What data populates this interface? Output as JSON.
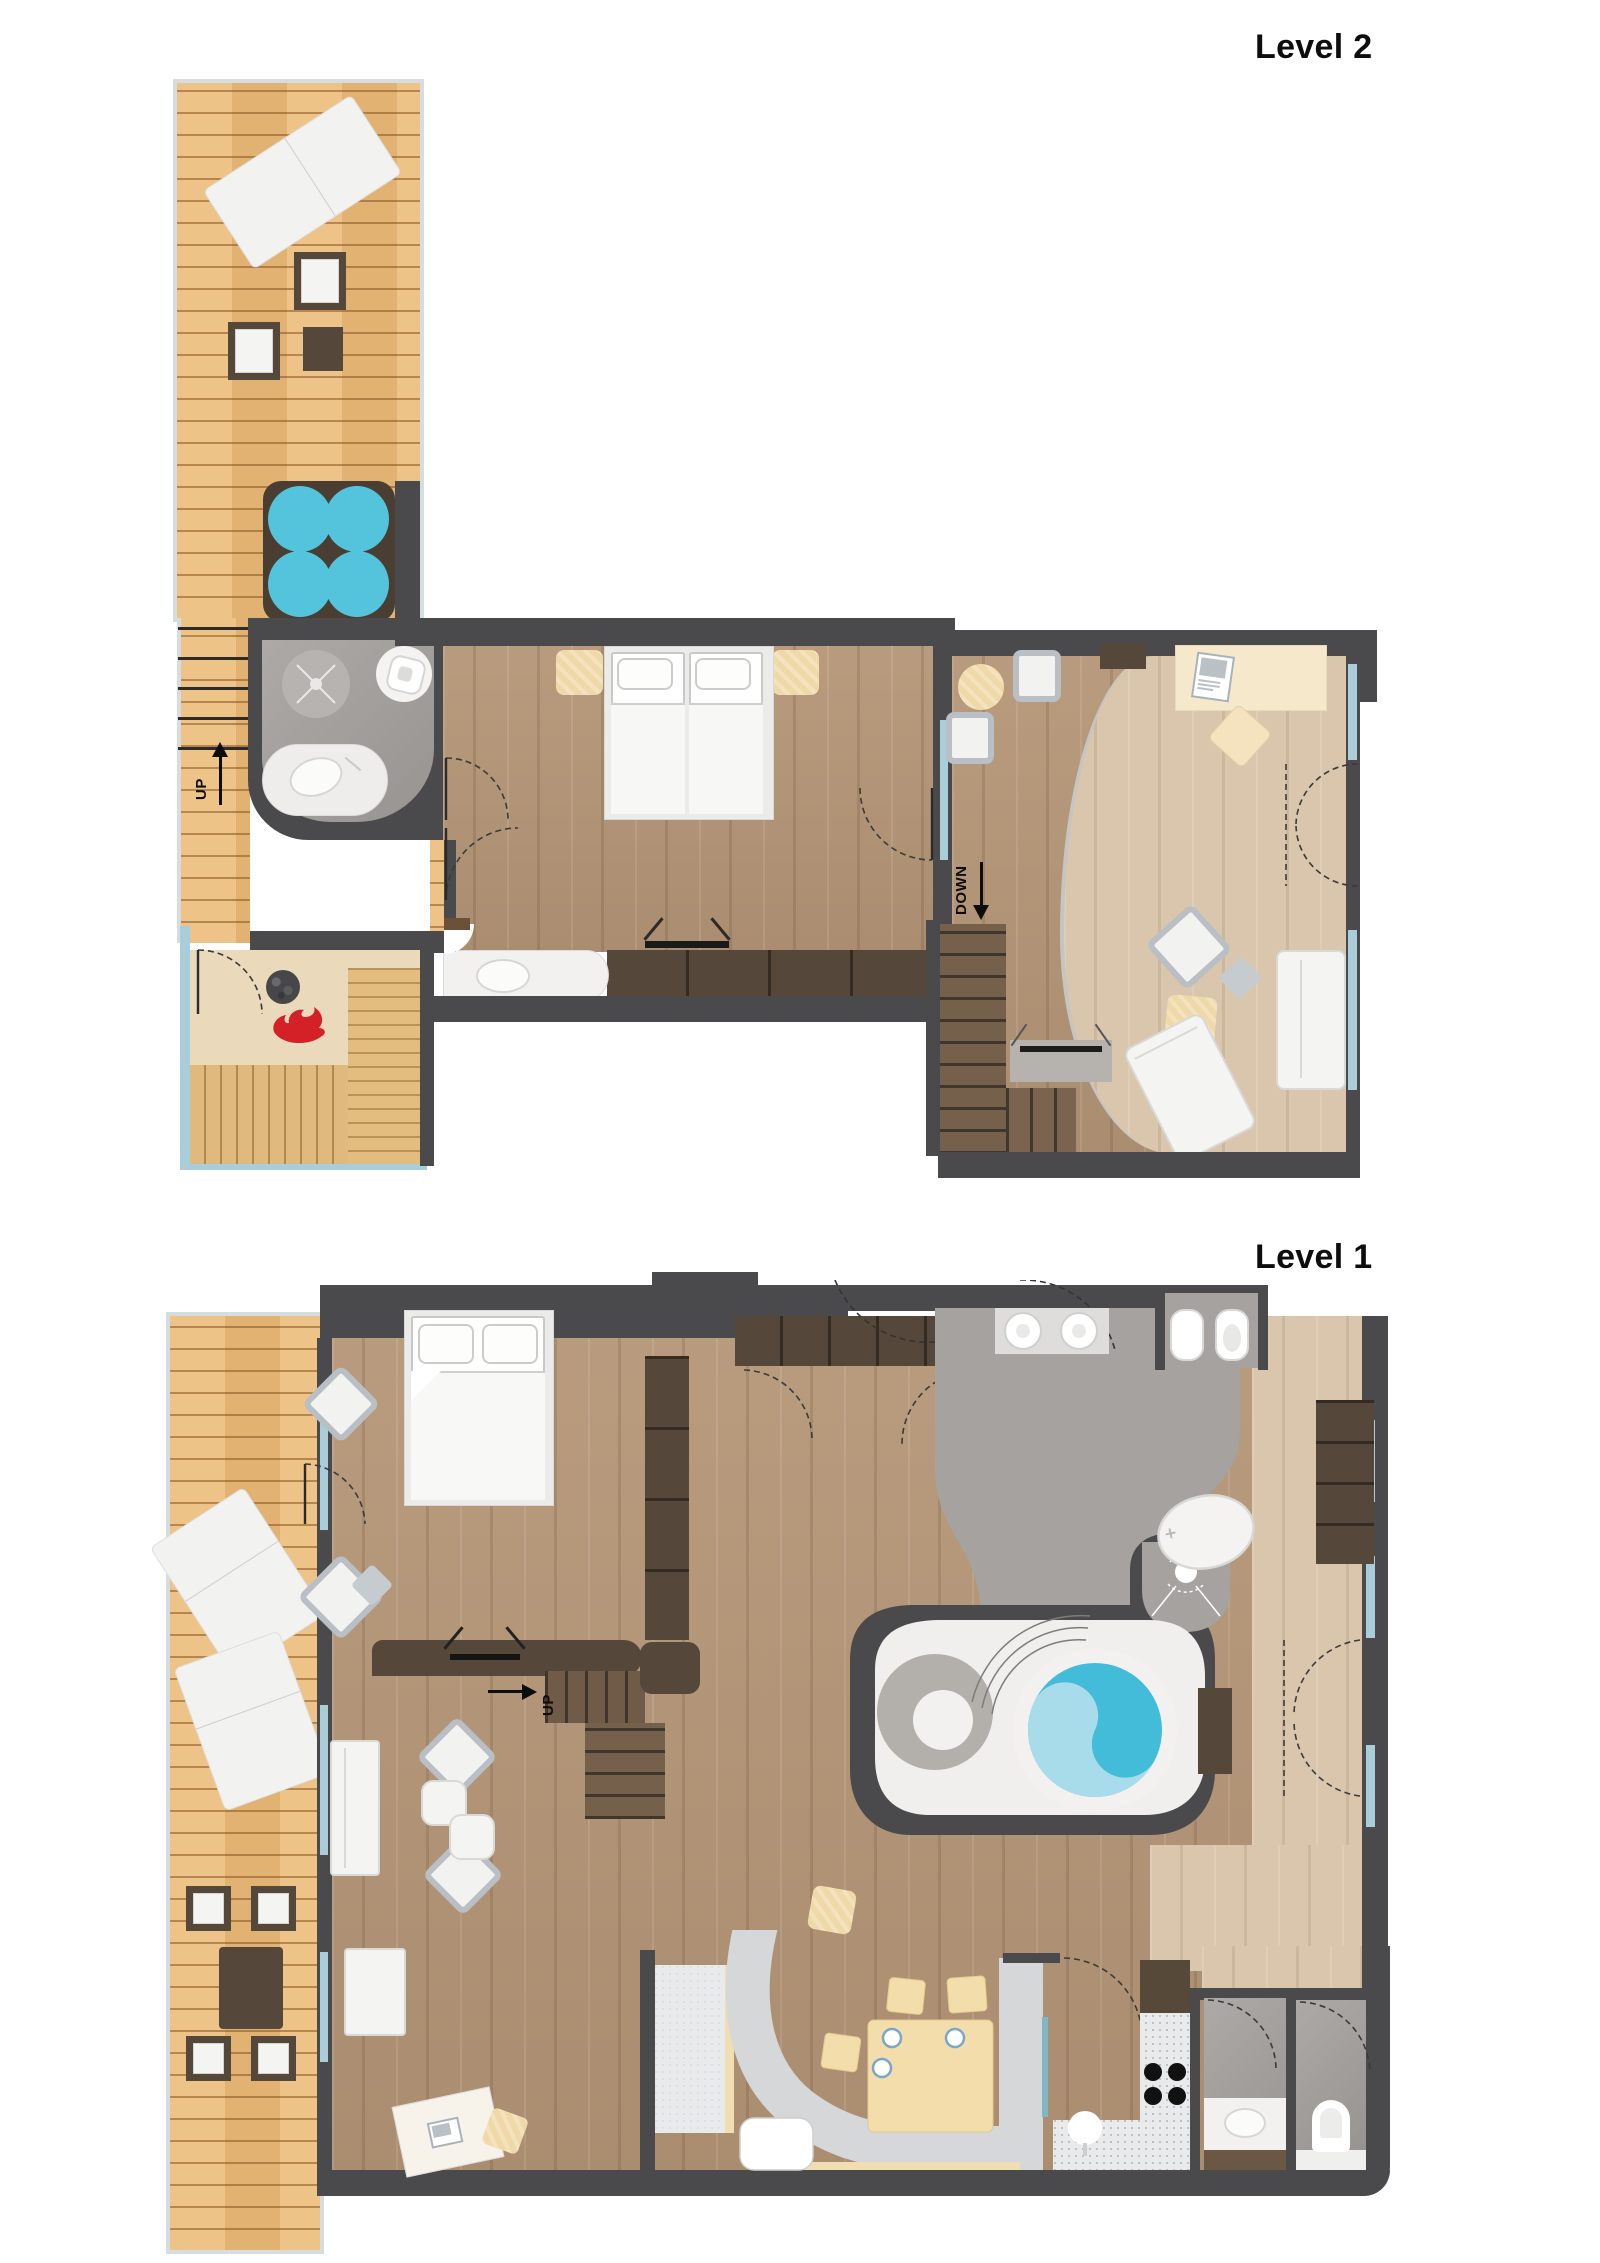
{
  "page": {
    "width": 1600,
    "height": 2263,
    "background": "#ffffff"
  },
  "levels": [
    {
      "id": "level-2",
      "label": "Level 2",
      "labels": {
        "up": "UP",
        "down": "DOWN"
      },
      "features": [
        "terrace-deck",
        "hot-tub",
        "outdoor-stairs",
        "bathroom",
        "sauna",
        "twin-bedroom",
        "lounge-studio",
        "interior-stairs"
      ]
    },
    {
      "id": "level-1",
      "label": "Level 1",
      "labels": {
        "up": "UP"
      },
      "features": [
        "terrace-deck",
        "outdoor-dining",
        "master-bedroom",
        "dressing-hall",
        "master-bathroom",
        "spa-pool",
        "living-room",
        "kitchen",
        "dining-banquette",
        "powder-rooms",
        "interior-stairs"
      ]
    }
  ],
  "colors": {
    "wall": "#4a4a4c",
    "deck_wood": "#edbe7e",
    "floor_wood": "#b59677",
    "floor_wood_light": "#d9c6ad",
    "sauna_wood": "#e0b97e",
    "hot_tub_water": "#54c4dd",
    "pool_water": "#43bcd9",
    "pool_swirl": "#a9dcea",
    "tile_gray": "#a3a09d",
    "glass": "#a9cdd9",
    "flame_red": "#d42127",
    "furniture_white": "#f4f4f3",
    "furniture_tan": "#f0d9a8",
    "cabinet_brown": "#55473a",
    "banquette_gray": "#d5d7d8"
  },
  "icons": [
    "flame-icon",
    "shower-icon",
    "rain-shower-icon",
    "tv-icon",
    "sink-icon",
    "toilet-icon",
    "bidet-icon",
    "cooktop-icon",
    "up-arrow-icon",
    "down-arrow-icon",
    "right-arrow-icon",
    "laptop-icon",
    "door-swing-icon",
    "hot-tub-icon",
    "spa-pool-icon"
  ]
}
